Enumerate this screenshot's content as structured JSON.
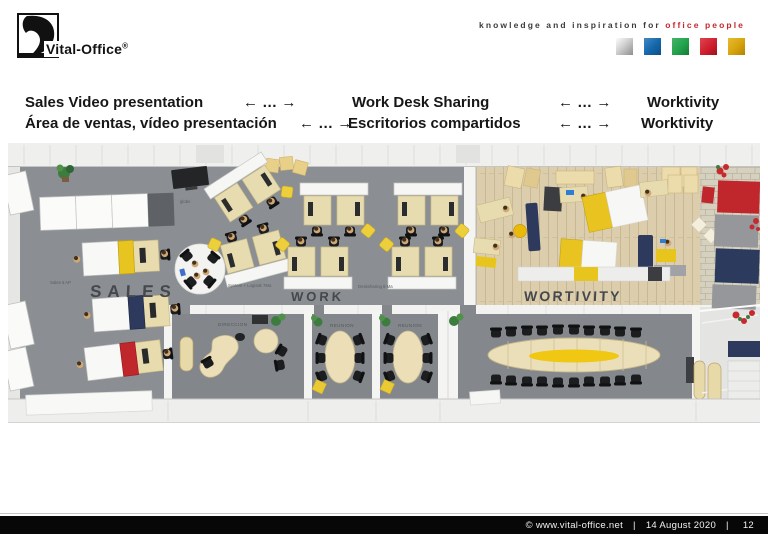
{
  "logo": {
    "text": "Vital-Office",
    "registered": "®"
  },
  "tagline": {
    "text_normal": "knowledge and inspiration for",
    "text_highlight": "office people"
  },
  "brand_squares": [
    {
      "name": "silver",
      "color": "#9a9a9a",
      "css": "background:linear-gradient(135deg,#fcfcfc 0%,#cfcfcf 45%,#8e8e8e 100%)"
    },
    {
      "name": "blue",
      "color": "#1366a9",
      "css": "background:linear-gradient(135deg,#4189c2 0%,#1366a9 55%,#0d4f86 100%)"
    },
    {
      "name": "green",
      "color": "#21a24b",
      "css": "background:linear-gradient(135deg,#45b46c 0%,#21a24b 55%,#147a36 100%)"
    },
    {
      "name": "red",
      "color": "#cf1e2d",
      "css": "background:linear-gradient(135deg,#de4450 0%,#cf1e2d 55%,#a31019 100%)"
    },
    {
      "name": "gold",
      "color": "#d7a30b",
      "css": "background:linear-gradient(135deg,#e5bb35 0%,#d7a30b 55%,#b08304 100%)"
    }
  ],
  "header": {
    "arrow": "← … →",
    "line1": {
      "seg1": "Sales Video presentation",
      "seg2": "Work Desk Sharing",
      "seg3": "Worktivity"
    },
    "line2": {
      "seg1": "Área de ventas, vídeo presentación",
      "seg2": "Escritorios compartidos",
      "seg3": "Worktivity"
    }
  },
  "floorplan": {
    "sales": {
      "label": "SALES",
      "sublabel": "Sales 6 AP",
      "tv_label": "globe"
    },
    "work": {
      "label": "WORK",
      "sublabel_left": "System + Logistik 7Ma",
      "sublabel_right": "Desksharing 8 Ma"
    },
    "wortivity": {
      "label": "WORTIVITY"
    },
    "rooms": {
      "direccion": "DIRECCION",
      "reunion1": "REUNION",
      "reunion2": "REUNION"
    }
  },
  "footer": {
    "copyright": "©  www.vital-office.net",
    "separator": "|",
    "date": "14 August 2020",
    "page": "12"
  },
  "colors": {
    "floor_gray": "#8b8f93",
    "room_gray": "#83878b",
    "wood": "#dccead",
    "brick": "#d6d0bf",
    "desk_beige": "#e7dcb0",
    "accent_yellow": "#e7c41f",
    "accent_navy": "#2d3a5e",
    "accent_red": "#bf272d",
    "tagline_red": "#c5262c"
  }
}
